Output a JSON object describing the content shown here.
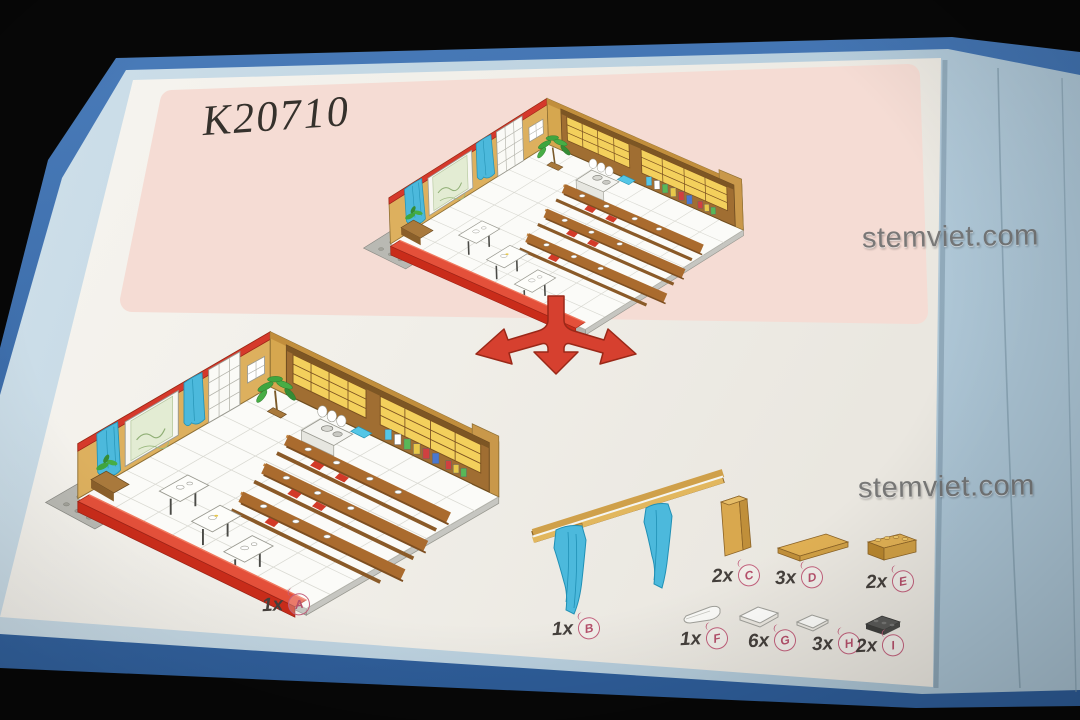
{
  "set_number": "K20710",
  "watermarks": [
    "stemviet.com",
    "stemviet.com"
  ],
  "parts": [
    {
      "id": "A",
      "qty": "1x"
    },
    {
      "id": "B",
      "qty": "1x"
    },
    {
      "id": "C",
      "qty": "2x"
    },
    {
      "id": "D",
      "qty": "3x"
    },
    {
      "id": "E",
      "qty": "2x"
    },
    {
      "id": "F",
      "qty": "1x"
    },
    {
      "id": "G",
      "qty": "6x"
    },
    {
      "id": "H",
      "qty": "3x"
    },
    {
      "id": "I",
      "qty": "2x"
    }
  ],
  "colors": {
    "cover_blue": "#3d6fae",
    "page_edge_blue": "#c2d6e2",
    "page_white": "#f2f0ea",
    "banner_pink": "#f5dcd4",
    "arrow_red": "#d6402f",
    "badge_pink": "#c2607c",
    "brick_tan": "#d9a84e",
    "wood_brown": "#a06e32",
    "bench_red": "#d83a28",
    "curtain_blue": "#4cb9dc"
  }
}
